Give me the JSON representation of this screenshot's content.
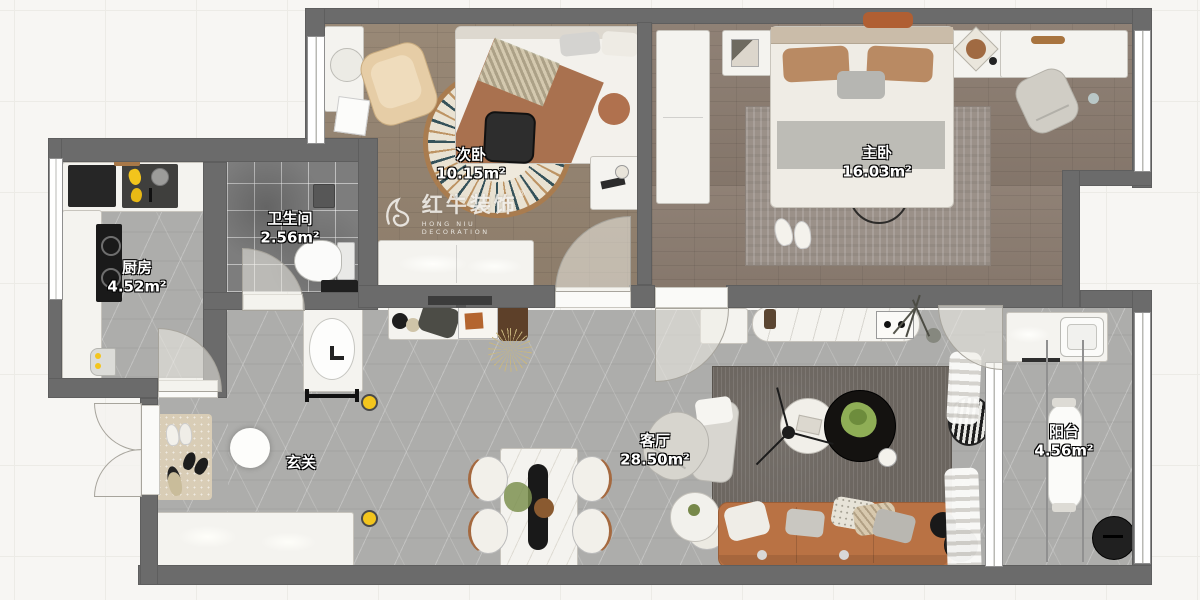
{
  "meta": {
    "type": "apartment-floor-plan",
    "width_px": 1200,
    "height_px": 600
  },
  "watermark": {
    "brand": "红牛装饰",
    "subtitle": "HONG NIU DECORATION",
    "registered": "®"
  },
  "rooms": [
    {
      "id": "secondary-bedroom",
      "name": "次卧",
      "area": "10.15m²"
    },
    {
      "id": "master-bedroom",
      "name": "主卧",
      "area": "16.03m²"
    },
    {
      "id": "bathroom",
      "name": "卫生间",
      "area": "2.56m²"
    },
    {
      "id": "kitchen",
      "name": "厨房",
      "area": "4.52m²"
    },
    {
      "id": "entry",
      "name": "玄关",
      "area": ""
    },
    {
      "id": "living-room",
      "name": "客厅",
      "area": "28.50m²"
    },
    {
      "id": "balcony",
      "name": "阳台",
      "area": "4.56m²"
    }
  ],
  "colors": {
    "wall": "#6b6b6b",
    "wood_floor_secondary": "#93826f",
    "wood_floor_master": "#8b7c70",
    "marble_floor": "#adadab",
    "bath_tile": "#7d7d7d",
    "sofa_leather": "#b97244",
    "accent_switch_yellow": "#f3c51d",
    "rug_cream": "#e9e2d2",
    "rug_rim_brown": "#a97c4f",
    "throw_brown": "#a9714f"
  }
}
